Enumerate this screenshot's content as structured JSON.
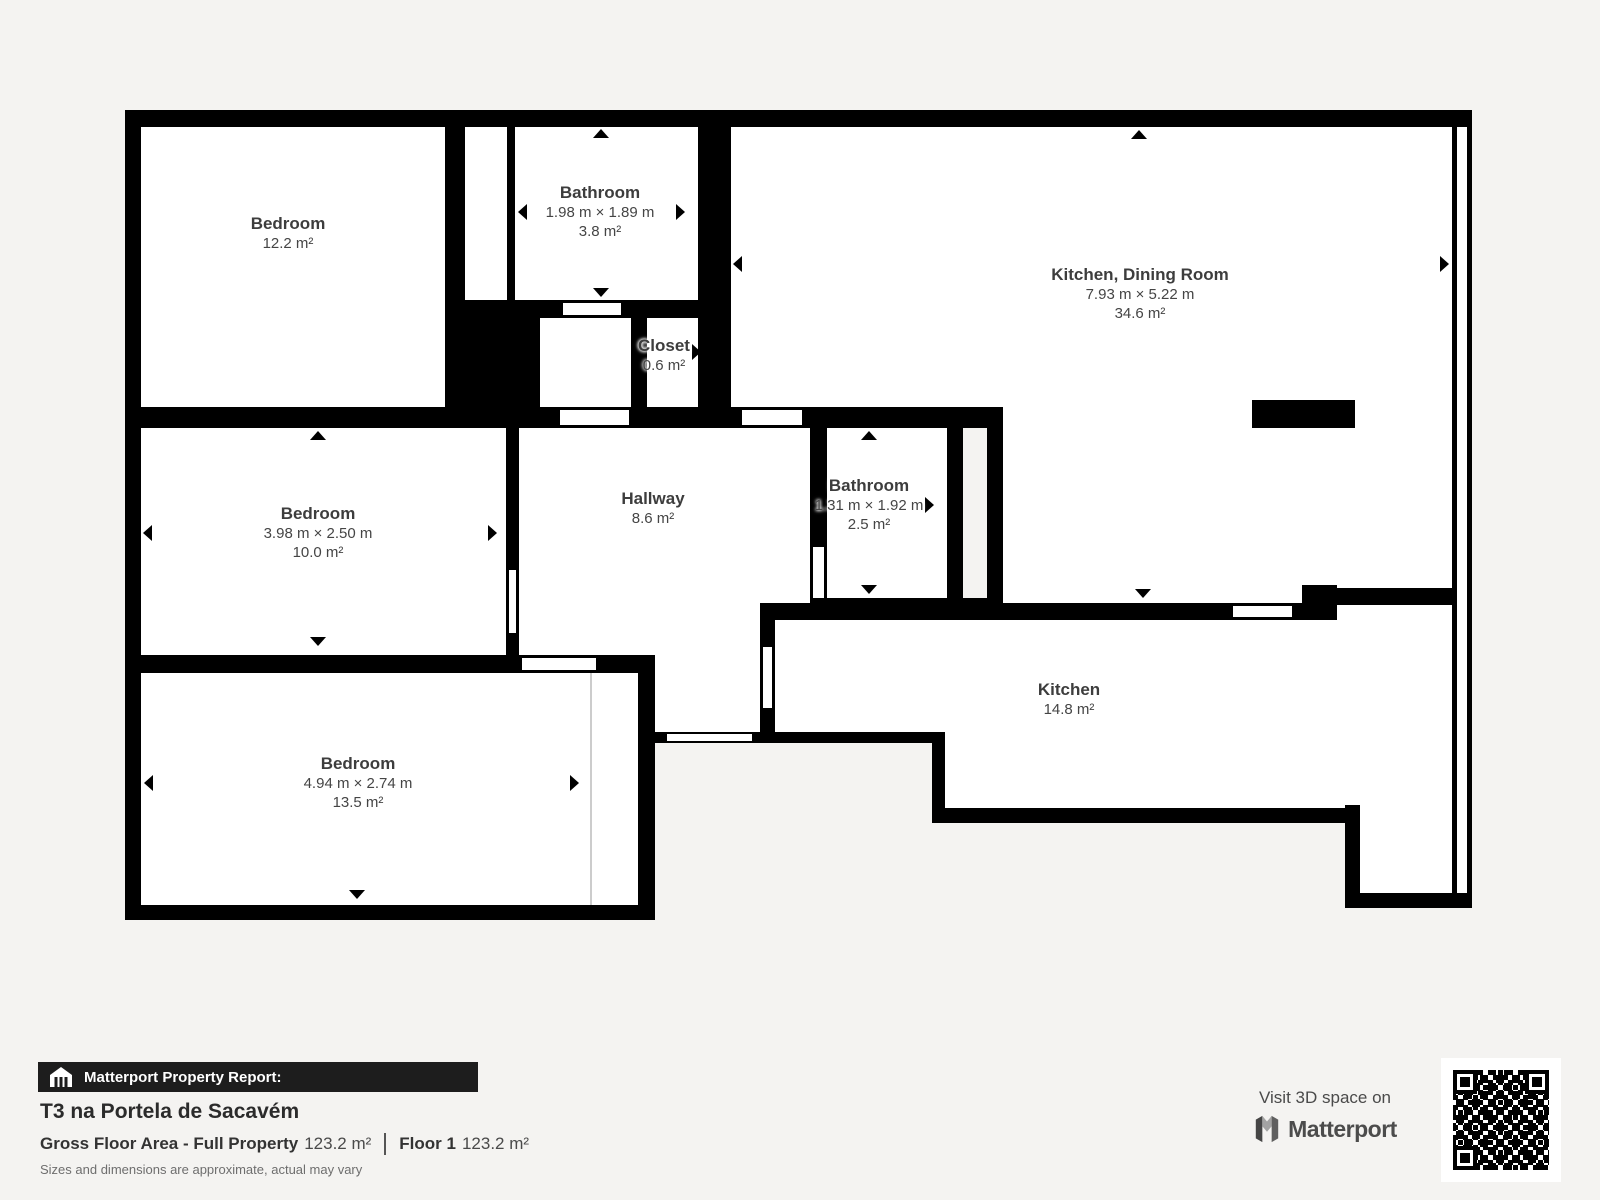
{
  "rooms": {
    "bedroom1": {
      "name": "Bedroom",
      "area": "12.2 m²"
    },
    "bathroom1": {
      "name": "Bathroom",
      "dims": "1.98 m × 1.89 m",
      "area": "3.8 m²"
    },
    "kitchen_dining": {
      "name": "Kitchen, Dining Room",
      "dims": "7.93 m × 5.22 m",
      "area": "34.6 m²"
    },
    "closet": {
      "name": "Closet",
      "area": "0.6 m²"
    },
    "bedroom2": {
      "name": "Bedroom",
      "dims": "3.98 m × 2.50 m",
      "area": "10.0 m²"
    },
    "hallway": {
      "name": "Hallway",
      "area": "8.6 m²"
    },
    "bathroom2": {
      "name": "Bathroom",
      "dims": "1.31 m × 1.92 m",
      "area": "2.5 m²"
    },
    "bedroom3": {
      "name": "Bedroom",
      "dims": "4.94 m × 2.74 m",
      "area": "13.5 m²"
    },
    "kitchen": {
      "name": "Kitchen",
      "area": "14.8 m²"
    }
  },
  "report": {
    "header": "Matterport Property Report:",
    "property_title": "T3 na Portela de Sacavém",
    "gfa_label": "Gross Floor Area - Full Property",
    "gfa_value": "123.2 m²",
    "floor_label": "Floor 1",
    "floor_value": "123.2 m²",
    "disclaimer": "Sizes and dimensions are approximate, actual may vary"
  },
  "branding": {
    "visit_text": "Visit 3D space on",
    "logo_text": "Matterport"
  },
  "colors": {
    "wall": "#000000",
    "room_fill": "#ffffff",
    "background": "#f4f3f1",
    "footer_bar": "#1d1d1d"
  }
}
